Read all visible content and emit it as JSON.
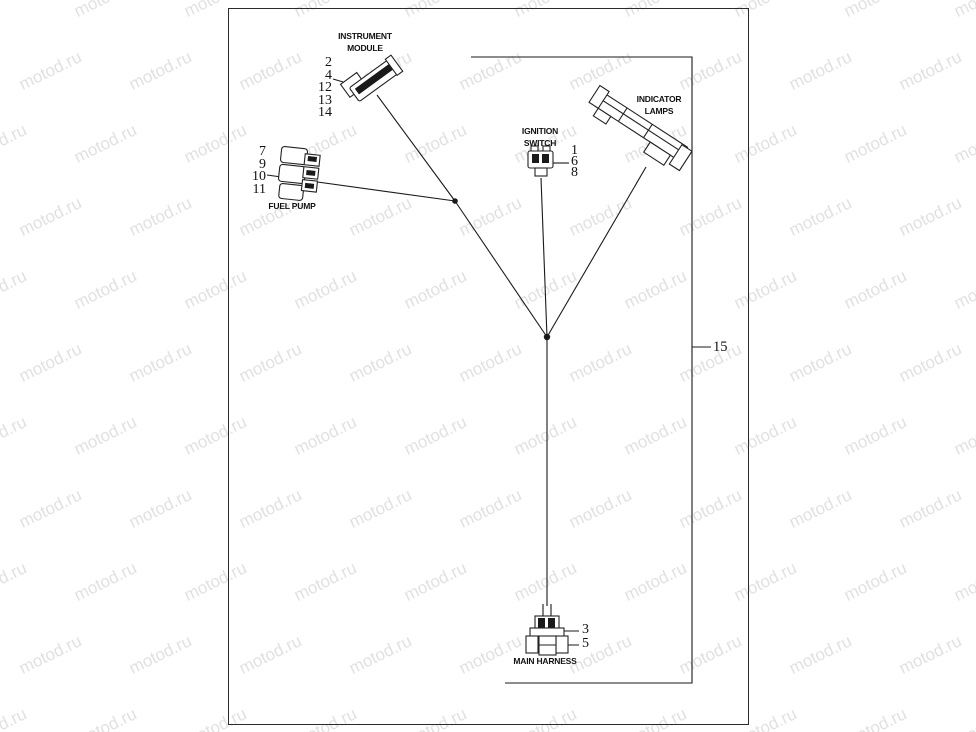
{
  "watermark": {
    "text": "motod.ru"
  },
  "diagram": {
    "instrument_module": {
      "label1": "INSTRUMENT",
      "label2": "MODULE",
      "numbers": [
        "2",
        "4",
        "12",
        "13",
        "14"
      ]
    },
    "ignition_switch": {
      "label1": "IGNITION",
      "label2": "SWITCH",
      "numbers": [
        "1",
        "6",
        "8"
      ]
    },
    "indicator_lamps": {
      "label1": "INDICATOR",
      "label2": "LAMPS"
    },
    "fuel_pump": {
      "label": "FUEL PUMP",
      "numbers": [
        "7",
        "9",
        "10",
        "11"
      ]
    },
    "main_harness": {
      "label": "MAIN HARNESS",
      "numbers": [
        "3",
        "5"
      ]
    },
    "harness_assembly": {
      "number": "15"
    }
  }
}
